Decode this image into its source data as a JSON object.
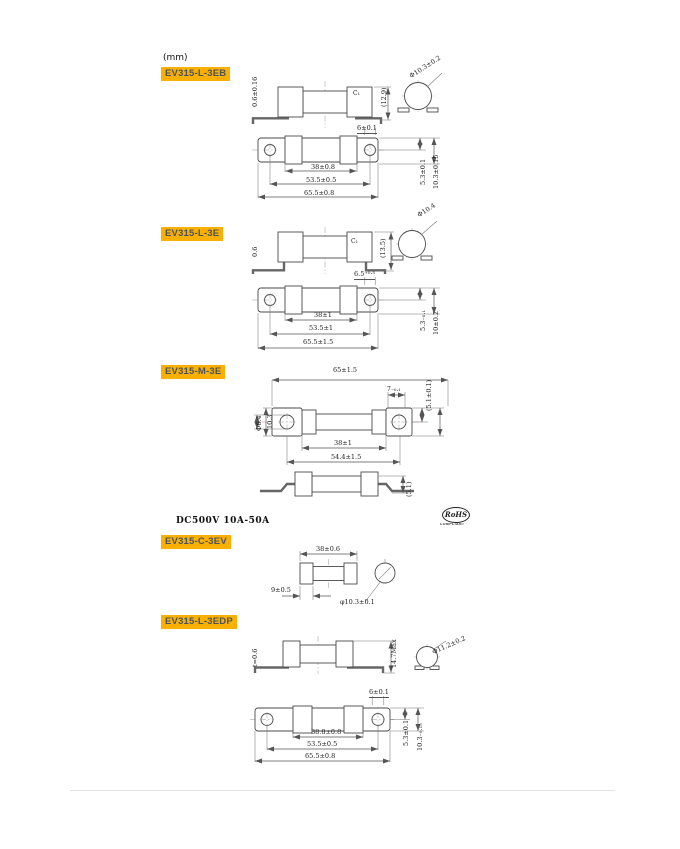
{
  "colors": {
    "highlight": "#F9B000",
    "chip_text": "#4A5265",
    "line": "#555555"
  },
  "page": {
    "unit": "(mm)",
    "spec": "DC500V  10A-50A",
    "rohs": {
      "name": "RoHS",
      "sub": "COMPLIANT"
    }
  },
  "sections": {
    "eb": {
      "label": "EV315-L-3EB",
      "dims": {
        "thickness": "0.6±0.16",
        "total_height": "(12.9)",
        "chamfer": "C₁",
        "diameter": "Φ10.3±0.2",
        "slot": "6±0.1",
        "body": "38±0.8",
        "holes": "53.5±0.5",
        "overall": "65.5±0.8",
        "v1": "5.3±0.1",
        "v2": "10.3±0.15"
      }
    },
    "e": {
      "label": "EV315-L-3E",
      "dims": {
        "thickness": "0.6",
        "total_height": "(13.5)",
        "chamfer": "C₁",
        "diameter": "Φ10.4",
        "slot": "6.5⁺⁰·⁵",
        "body": "38±1",
        "holes": "53.5±1",
        "overall": "65.5±1.5",
        "v1": "5.3₋₀.₁",
        "v2": "10±0.2"
      }
    },
    "m": {
      "label": "EV315-M-3E",
      "dims": {
        "overall": "65±1.5",
        "hole": "Φ6.4",
        "width": "10.3",
        "tab": "7₋₀.₁",
        "tab_height": "(5.1±0.1)",
        "body": "38±1",
        "terminals": "54.4±1.5",
        "leg_height": "(5.1)"
      }
    },
    "c": {
      "label": "EV315-C-3EV",
      "dims": {
        "length": "38±0.6",
        "cap": "9±0.5",
        "diameter": "φ10.3±0.1"
      }
    },
    "edp": {
      "label": "EV315-L-3EDP",
      "dims": {
        "thickness": "t=0.6",
        "max_height": "14.7Max",
        "diameter": "Φ11.2±0.2",
        "slot": "6±0.1",
        "body": "38.8±0.8",
        "holes": "53.5±0.5",
        "overall": "65.5±0.8",
        "v1": "5.3±0.1",
        "v2": "10.3₋₀.₁₅"
      }
    }
  }
}
